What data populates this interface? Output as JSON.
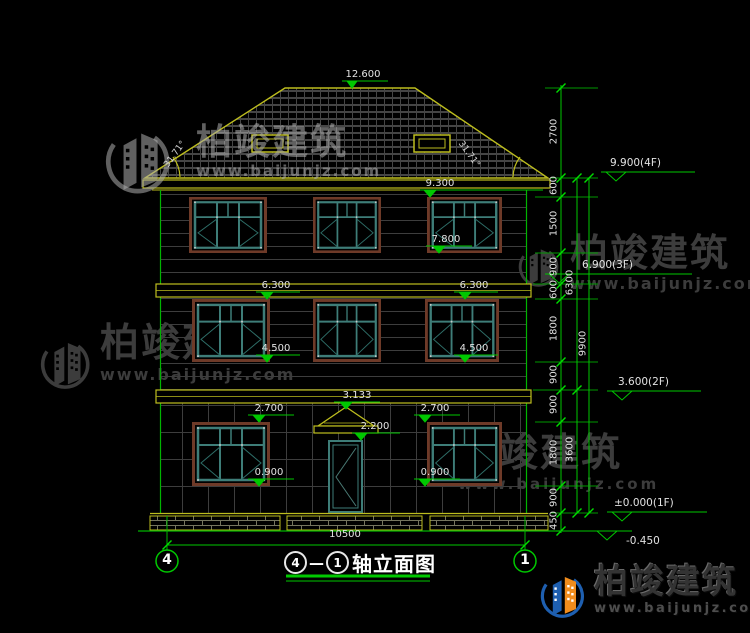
{
  "drawing": {
    "peak_mark": "12.600",
    "roof_angle_left": "31.71°",
    "roof_angle_right": "31.71°",
    "facade_marks": {
      "h9300": "9.300",
      "h7800": "7.800",
      "h6300_left": "6.300",
      "h6300_right": "6.300",
      "h4500_left": "4.500",
      "h4500_right": "4.500",
      "h3133": "3.133",
      "h2700_left": "2.700",
      "h2700_right": "2.700",
      "h2200": "2.200",
      "h0900_left": "0.900",
      "h0900_right": "0.900"
    },
    "level_flags": {
      "f4": "9.900(4F)",
      "f3": "6.900(3F)",
      "f2": "3.600(2F)",
      "f1": "±0.000(1F)",
      "ground": "-0.450"
    },
    "dims": {
      "inner": [
        "2700",
        "600",
        "1500",
        "900",
        "600",
        "1800",
        "900",
        "900",
        "1800",
        "900",
        "450"
      ],
      "mid": [
        "6300",
        "3600"
      ],
      "outer": [
        "9900"
      ],
      "width": "10500"
    },
    "axes": {
      "left": "4",
      "right": "1"
    },
    "title": {
      "from": "4",
      "sep": "—",
      "to": "1",
      "text": "轴立面图"
    }
  },
  "watermark": {
    "brand": "柏竣建筑",
    "site": "www.baijunjz.com"
  },
  "colors": {
    "line_green": "#00c800",
    "line_yellow": "#bdbd1e",
    "window_teal": "#3e7d78",
    "window_brown": "#6e3a28",
    "logo_blue": "#1e5fb0",
    "logo_orange": "#f08c1c",
    "text": "#e2e2e2",
    "watermark_gray": "#3c3c3c"
  }
}
